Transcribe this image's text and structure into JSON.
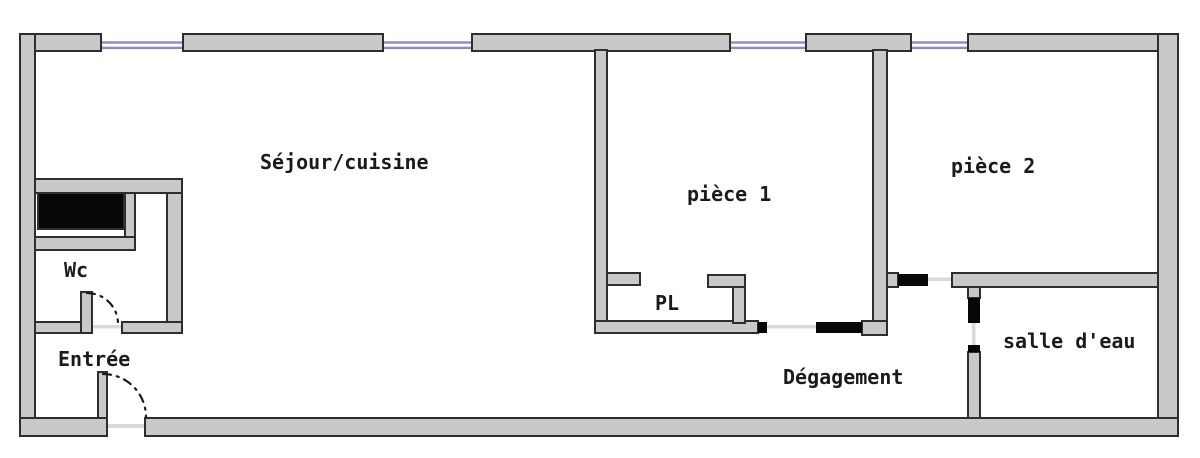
{
  "diagram": {
    "type": "floor-plan",
    "canvas": {
      "width": 1200,
      "height": 458
    },
    "colors": {
      "background": "#ffffff",
      "wall_fill": "#c9c9c9",
      "wall_stroke": "#2e2e2e",
      "door_black": "#070707",
      "window_blue": "#8c8cc2",
      "threshold": "#d9d9d9",
      "label": "#1b1b1b",
      "arc": "#1a1a1a"
    },
    "rooms": [
      {
        "id": "sejour-cuisine",
        "label": "Séjour/cuisine",
        "x": 260,
        "y": 169,
        "size": 20
      },
      {
        "id": "piece-1",
        "label": "pièce 1",
        "x": 687,
        "y": 201,
        "size": 20
      },
      {
        "id": "piece-2",
        "label": "pièce 2",
        "x": 951,
        "y": 173,
        "size": 20
      },
      {
        "id": "wc",
        "label": "Wc",
        "x": 64,
        "y": 277,
        "size": 20
      },
      {
        "id": "entree",
        "label": "Entrée",
        "x": 58,
        "y": 366,
        "size": 20
      },
      {
        "id": "pl",
        "label": "PL",
        "x": 655,
        "y": 310,
        "size": 20
      },
      {
        "id": "degagement",
        "label": "Dégagement",
        "x": 783,
        "y": 384,
        "size": 20
      },
      {
        "id": "salle-d-eau",
        "label": "salle d'eau",
        "x": 1003,
        "y": 348,
        "size": 20
      }
    ],
    "walls": [
      {
        "x": 20,
        "y": 34,
        "w": 81,
        "h": 17
      },
      {
        "x": 183,
        "y": 34,
        "w": 200,
        "h": 17
      },
      {
        "x": 472,
        "y": 34,
        "w": 258,
        "h": 17
      },
      {
        "x": 806,
        "y": 34,
        "w": 105,
        "h": 17
      },
      {
        "x": 968,
        "y": 34,
        "w": 210,
        "h": 17
      },
      {
        "x": 20,
        "y": 34,
        "w": 15,
        "h": 402
      },
      {
        "x": 1158,
        "y": 34,
        "w": 20,
        "h": 402
      },
      {
        "x": 20,
        "y": 418,
        "w": 87,
        "h": 18
      },
      {
        "x": 145,
        "y": 418,
        "w": 1033,
        "h": 18
      },
      {
        "x": 595,
        "y": 50,
        "w": 12,
        "h": 283
      },
      {
        "x": 873,
        "y": 50,
        "w": 14,
        "h": 285
      },
      {
        "x": 595,
        "y": 321,
        "w": 163,
        "h": 12
      },
      {
        "x": 862,
        "y": 321,
        "w": 25,
        "h": 14
      },
      {
        "x": 952,
        "y": 273,
        "w": 206,
        "h": 14
      },
      {
        "x": 887,
        "y": 273,
        "w": 11,
        "h": 14
      },
      {
        "x": 968,
        "y": 287,
        "w": 12,
        "h": 11
      },
      {
        "x": 968,
        "y": 352,
        "w": 12,
        "h": 66
      },
      {
        "x": 607,
        "y": 273,
        "w": 33,
        "h": 12
      },
      {
        "x": 708,
        "y": 275,
        "w": 37,
        "h": 12
      },
      {
        "x": 733,
        "y": 287,
        "w": 12,
        "h": 36
      },
      {
        "x": 35,
        "y": 179,
        "w": 147,
        "h": 14
      },
      {
        "x": 167,
        "y": 193,
        "w": 15,
        "h": 129
      },
      {
        "x": 125,
        "y": 193,
        "w": 10,
        "h": 57
      },
      {
        "x": 35,
        "y": 237,
        "w": 100,
        "h": 13
      },
      {
        "x": 35,
        "y": 322,
        "w": 48,
        "h": 11
      },
      {
        "x": 122,
        "y": 322,
        "w": 60,
        "h": 11
      }
    ],
    "black_elements": [
      {
        "id": "duct-shaft",
        "x": 38,
        "y": 193,
        "w": 86,
        "h": 36,
        "outlined": true
      },
      {
        "id": "piece1-door-jamb",
        "x": 758,
        "y": 322,
        "w": 9,
        "h": 11,
        "outlined": false
      },
      {
        "id": "piece1-door-panel",
        "x": 816,
        "y": 322,
        "w": 46,
        "h": 11,
        "outlined": false
      },
      {
        "id": "piece2-door-panel",
        "x": 898,
        "y": 274,
        "w": 30,
        "h": 12,
        "outlined": false
      },
      {
        "id": "bath-door-panel",
        "x": 968,
        "y": 298,
        "w": 12,
        "h": 25,
        "outlined": false
      },
      {
        "id": "bath-door-jamb",
        "x": 968,
        "y": 345,
        "w": 12,
        "h": 7,
        "outlined": false
      }
    ],
    "windows": [
      {
        "x1": 101,
        "x2": 183
      },
      {
        "x1": 383,
        "x2": 472
      },
      {
        "x1": 730,
        "x2": 806
      },
      {
        "x1": 911,
        "x2": 968
      }
    ],
    "window_lines_y": [
      41.3,
      46.7
    ],
    "window_line_h": 2.4,
    "thresholds": [
      {
        "x": 92,
        "y": 325,
        "w": 30,
        "h": 3.5
      },
      {
        "x": 107,
        "y": 424,
        "w": 38,
        "h": 4
      },
      {
        "x": 767,
        "y": 325,
        "w": 49,
        "h": 3.5
      },
      {
        "x": 928,
        "y": 277.5,
        "w": 24,
        "h": 3.5
      },
      {
        "x": 972,
        "y": 323,
        "w": 3.5,
        "h": 22
      }
    ],
    "door_leaves": [
      {
        "id": "wc-door-leaf",
        "x": 81,
        "y": 292,
        "w": 11,
        "h": 41
      },
      {
        "id": "entree-door-leaf",
        "x": 98,
        "y": 372,
        "w": 9,
        "h": 46
      }
    ],
    "door_arcs": [
      {
        "id": "wc-door-swing",
        "d": "M 87 293 A 31 31 0 0 1 118 322"
      },
      {
        "id": "entree-door-swing",
        "d": "M 103 374 A 43 43 0 0 1 146 417"
      }
    ]
  }
}
